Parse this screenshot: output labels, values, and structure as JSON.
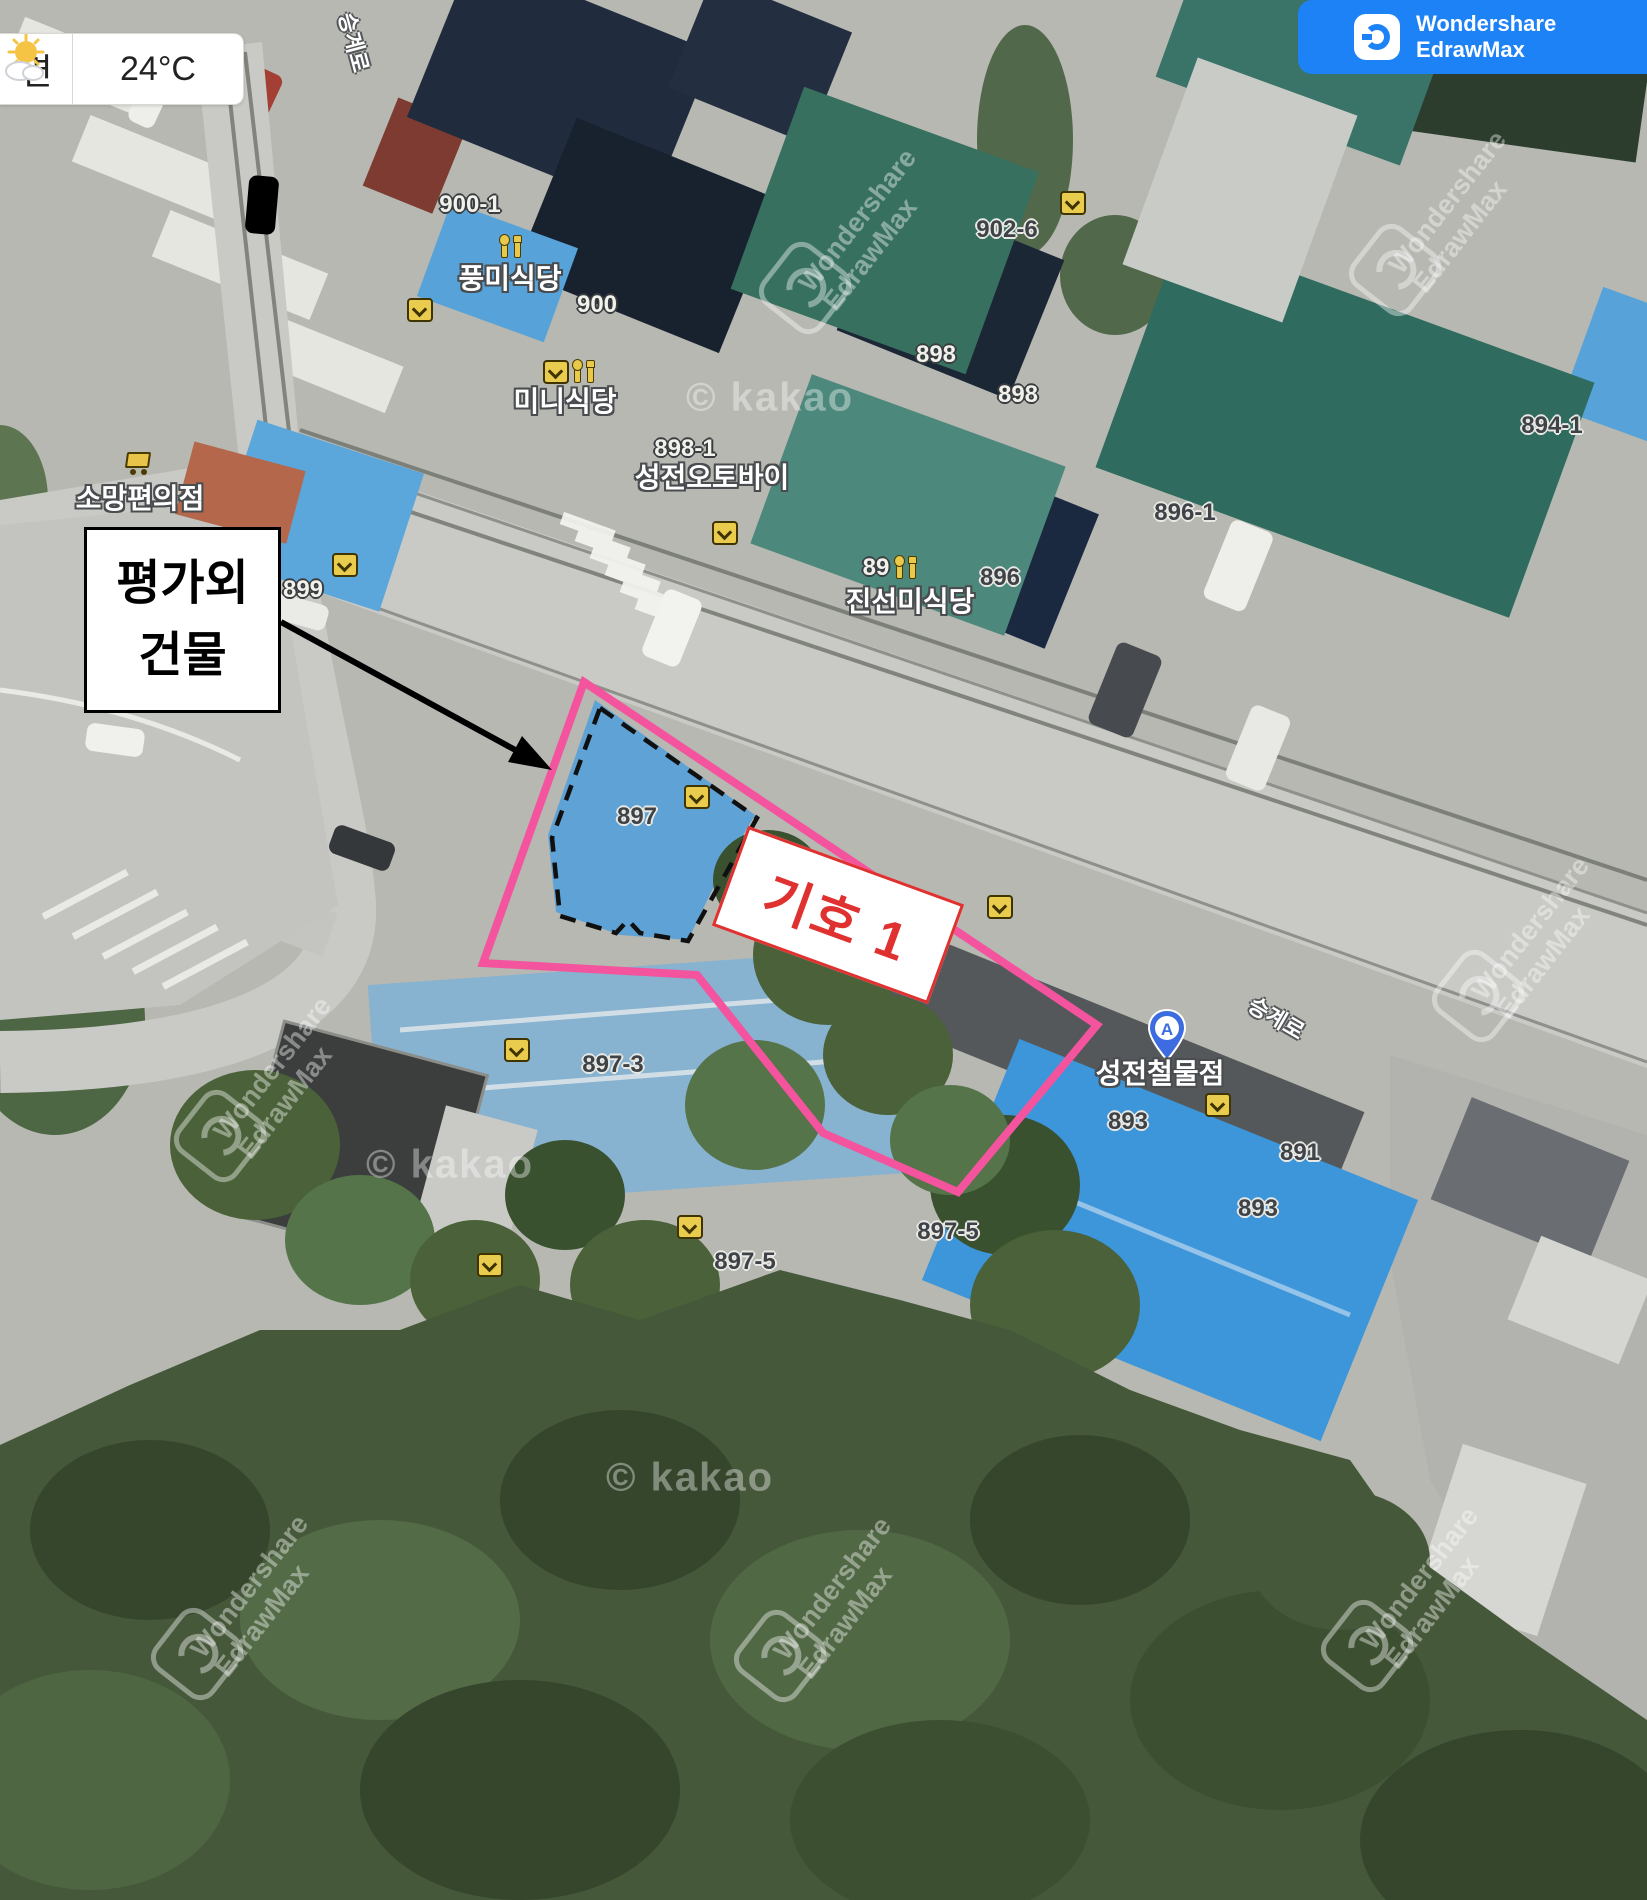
{
  "weather": {
    "area_label": "면",
    "temperature": "24°C"
  },
  "brand": {
    "line1": "Wondershare",
    "line2": "EdrawMax"
  },
  "annotations": {
    "excluded_building_line1": "평가외",
    "excluded_building_line2": "건물",
    "symbol_label": "기호 1",
    "outline_color": "#f4539e",
    "symbol_color": "#e03131"
  },
  "map": {
    "road_name": "승계로",
    "watermark_kakao": "© kakao",
    "marker": {
      "letter": "A",
      "label": "성전철물점"
    },
    "parcel_labels": [
      {
        "text": "900-1",
        "x": 470,
        "y": 205,
        "style": "light"
      },
      {
        "text": "900",
        "x": 597,
        "y": 305,
        "style": "light"
      },
      {
        "text": "898-1",
        "x": 685,
        "y": 449,
        "style": "light"
      },
      {
        "text": "898",
        "x": 936,
        "y": 355,
        "style": "light"
      },
      {
        "text": "898",
        "x": 1018,
        "y": 395,
        "style": "light"
      },
      {
        "text": "899",
        "x": 303,
        "y": 590,
        "style": "light"
      },
      {
        "text": "89",
        "x": 876,
        "y": 568,
        "style": "light"
      },
      {
        "text": "902-6",
        "x": 1007,
        "y": 230,
        "style": "dark"
      },
      {
        "text": "894-1",
        "x": 1552,
        "y": 426,
        "style": "dark"
      },
      {
        "text": "896-1",
        "x": 1185,
        "y": 513,
        "style": "dark"
      },
      {
        "text": "896",
        "x": 1000,
        "y": 578,
        "style": "dark"
      },
      {
        "text": "897",
        "x": 637,
        "y": 817,
        "style": "dark"
      },
      {
        "text": "897-3",
        "x": 613,
        "y": 1065,
        "style": "dark"
      },
      {
        "text": "897-5",
        "x": 948,
        "y": 1232,
        "style": "dark"
      },
      {
        "text": "897-5",
        "x": 745,
        "y": 1262,
        "style": "dark"
      },
      {
        "text": "893",
        "x": 1128,
        "y": 1122,
        "style": "dark"
      },
      {
        "text": "893",
        "x": 1258,
        "y": 1209,
        "style": "dark"
      },
      {
        "text": "891",
        "x": 1300,
        "y": 1153,
        "style": "dark"
      }
    ],
    "poi_labels": [
      {
        "text": "풍미식당",
        "x": 510,
        "y": 277
      },
      {
        "text": "미니식당",
        "x": 565,
        "y": 400
      },
      {
        "text": "성전오토바이",
        "x": 712,
        "y": 476
      },
      {
        "text": "진선미식당",
        "x": 910,
        "y": 600
      },
      {
        "text": "소망편의점",
        "x": 140,
        "y": 497
      }
    ],
    "road_labels": [
      {
        "x": 355,
        "y": 42,
        "rot": 75
      },
      {
        "x": 1277,
        "y": 1017,
        "rot": 30
      }
    ],
    "icons": [
      {
        "type": "restaurant",
        "x": 510,
        "y": 247
      },
      {
        "type": "restaurant",
        "x": 583,
        "y": 372
      },
      {
        "type": "restaurant",
        "x": 905,
        "y": 568
      },
      {
        "type": "cart",
        "x": 137,
        "y": 463
      },
      {
        "type": "flag",
        "x": 420,
        "y": 310
      },
      {
        "type": "flag",
        "x": 556,
        "y": 372
      },
      {
        "type": "flag",
        "x": 725,
        "y": 533
      },
      {
        "type": "flag",
        "x": 1073,
        "y": 203
      },
      {
        "type": "flag",
        "x": 697,
        "y": 797
      },
      {
        "type": "flag",
        "x": 345,
        "y": 565
      },
      {
        "type": "flag",
        "x": 517,
        "y": 1050
      },
      {
        "type": "flag",
        "x": 690,
        "y": 1227
      },
      {
        "type": "flag",
        "x": 490,
        "y": 1265
      },
      {
        "type": "flag",
        "x": 1218,
        "y": 1105
      },
      {
        "type": "flag",
        "x": 1000,
        "y": 907
      }
    ],
    "kakao_watermarks": [
      {
        "x": 770,
        "y": 398
      },
      {
        "x": 450,
        "y": 1165
      },
      {
        "x": 690,
        "y": 1478
      }
    ],
    "brand_watermarks": [
      {
        "x": 870,
        "y": 230
      },
      {
        "x": 1460,
        "y": 212
      },
      {
        "x": 285,
        "y": 1078
      },
      {
        "x": 1543,
        "y": 938
      },
      {
        "x": 262,
        "y": 1596
      },
      {
        "x": 845,
        "y": 1598
      },
      {
        "x": 1432,
        "y": 1588
      }
    ]
  }
}
